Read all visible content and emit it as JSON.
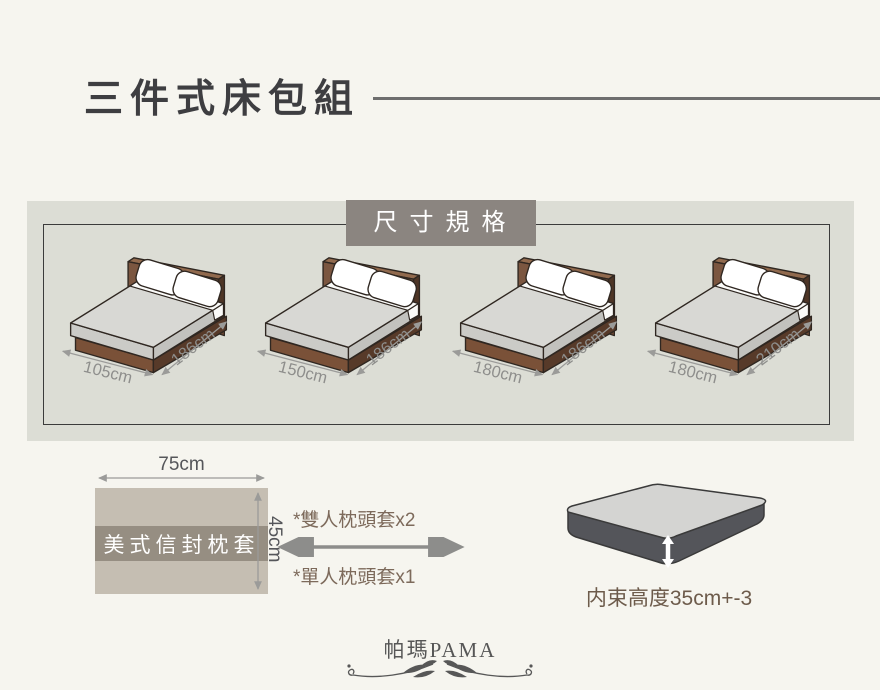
{
  "header": {
    "title": "三件式床包組"
  },
  "spec": {
    "badge": "尺寸規格",
    "beds": [
      {
        "width": "105cm",
        "length": "186cm"
      },
      {
        "width": "150cm",
        "length": "186cm"
      },
      {
        "width": "180cm",
        "length": "186cm"
      },
      {
        "width": "180cm",
        "length": "210cm"
      }
    ]
  },
  "pillow": {
    "width_label": "75cm",
    "height_label": "45cm",
    "name": "美式信封枕套",
    "note_double": "*雙人枕頭套x2",
    "note_single": "*單人枕頭套x1"
  },
  "mattress": {
    "label": "内束高度35cm+-3"
  },
  "footer": {
    "brand": "帕瑪PAMA"
  },
  "colors": {
    "page_bg": "#f6f5ef",
    "panel_bg": "#dcddd5",
    "badge_bg": "#8b8580",
    "headboard_brown": "#7b5640",
    "base_brown": "#7a5138",
    "mattress_top_gray": "#d8d8d4",
    "mattress_side_dark": "#54555a",
    "pillowcase_tan": "#c5beb2",
    "pillowcase_band": "#968e82",
    "dimension_text": "#8e8e8c",
    "note_text": "#7d6a5b",
    "mattress_label_text": "#6d5b4b",
    "title_text": "#3e3e41"
  }
}
